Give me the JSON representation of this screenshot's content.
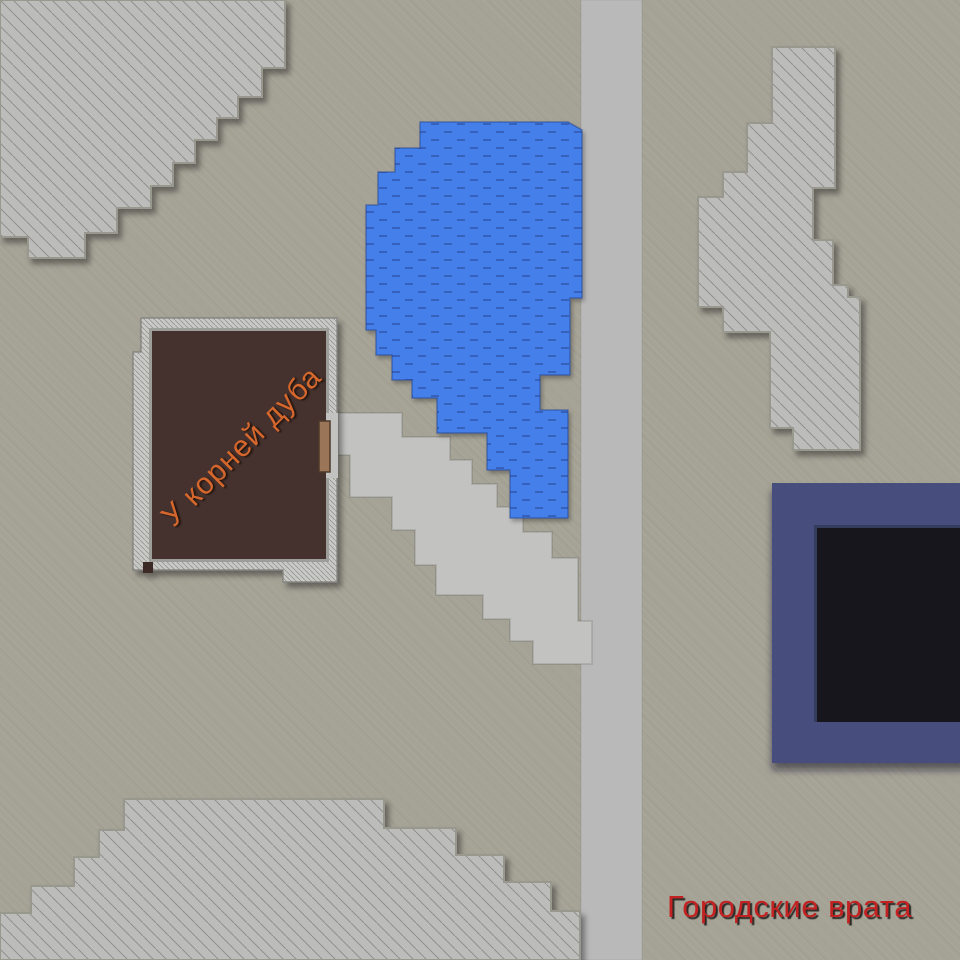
{
  "labels": {
    "building": "У корней дуба",
    "gate": "Городские врата"
  },
  "colors": {
    "background": "#a5a296",
    "road": "#b9b9b9",
    "path": "#c2c2c0",
    "rock": "#bcbcba",
    "wall": "#c9c9c6",
    "wall_inner_edge": "#9d9d99",
    "floor": "#44312d",
    "floor_gap": "#3a2a27",
    "door": "#9b7558",
    "lake": "#4480ea",
    "navy_frame": "#464d7b",
    "navy_bevel": "#363c5e",
    "navy_inner": "#12151f",
    "label_building": "#d5672d",
    "label_gate": "#c32222"
  },
  "regions": [
    {
      "name": "cliff-top-left",
      "kind": "rocks"
    },
    {
      "name": "cliff-top-right",
      "kind": "rocks"
    },
    {
      "name": "cliff-bottom-left",
      "kind": "rocks"
    },
    {
      "name": "lake",
      "kind": "water"
    },
    {
      "name": "road-vertical",
      "kind": "road"
    },
    {
      "name": "stair-path",
      "kind": "road"
    },
    {
      "name": "tavern-building",
      "kind": "building"
    },
    {
      "name": "city-gate-structure",
      "kind": "building"
    }
  ]
}
